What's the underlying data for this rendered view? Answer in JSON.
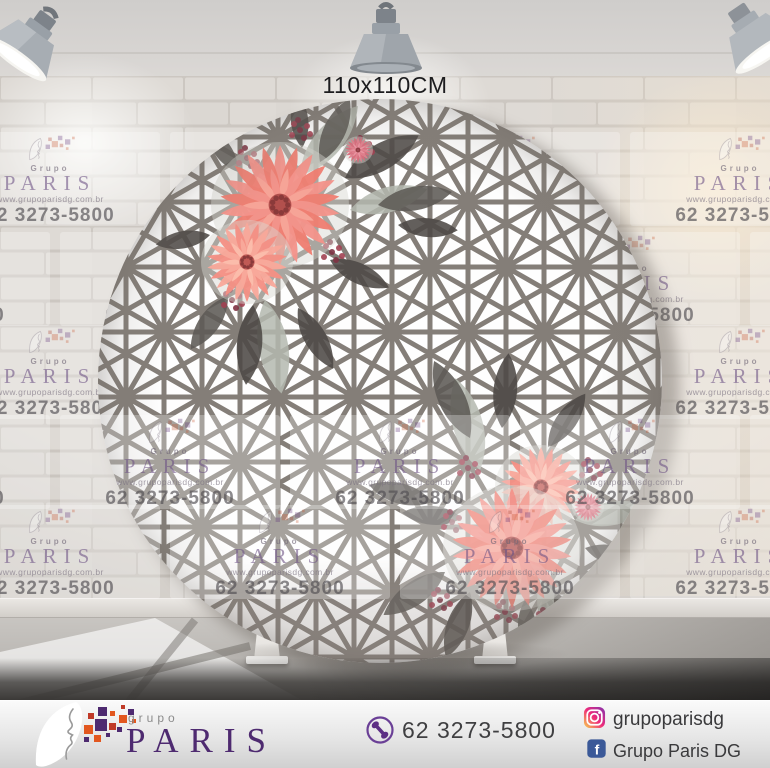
{
  "label": {
    "dimensions": "110x110CM"
  },
  "watermark": {
    "brand_top": "Grupo",
    "brand": "PARIS",
    "website": "www.grupoparisdg.com.br",
    "phone": "62 3273-5800"
  },
  "footer": {
    "brand_top": "grupo",
    "brand": "PARIS",
    "phone": "62 3273-5800",
    "instagram_handle": "grupoparisdg",
    "facebook_name": "Grupo Paris DG"
  },
  "icons": {
    "phone": "phone-icon",
    "instagram": "instagram-icon",
    "facebook": "facebook-icon",
    "logo_face": "face-logo-icon",
    "watermark_logo": "watermark-logo-icon",
    "spotlight": "spotlight-icon"
  },
  "colors": {
    "brand_purple": "#4e2a70",
    "accent_orange": "#e2571f",
    "accent_red": "#c03a28",
    "facebook_blue": "#3b5998",
    "flower_coral": "#ee7e71",
    "pattern_line": "#847e78",
    "text_dark": "#3f3f41"
  }
}
